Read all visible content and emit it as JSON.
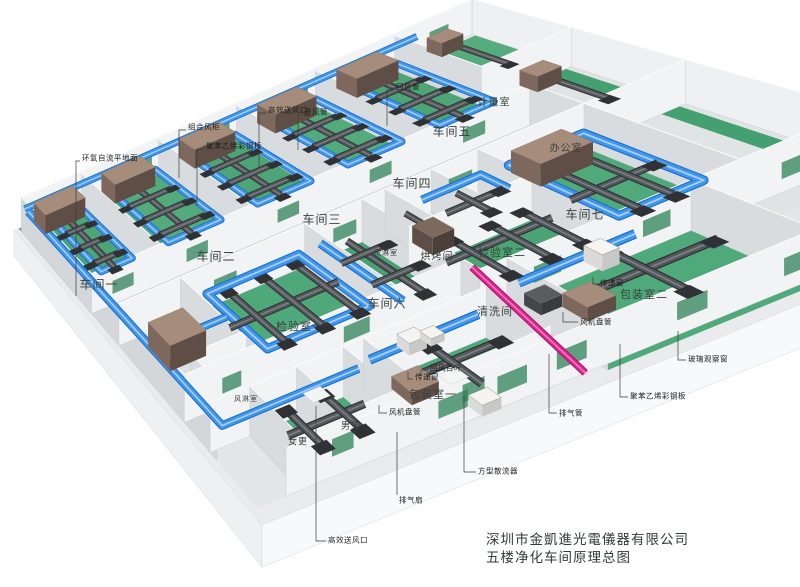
{
  "title_block": {
    "company": "深圳市金凱進光電儀器有限公司",
    "drawing_title": "五楼净化车间原理总图",
    "x": 486,
    "y": 531
  },
  "room_labels": [
    {
      "id": "workshop-1",
      "text": "车间一",
      "x": 99,
      "y": 284,
      "size": 12
    },
    {
      "id": "workshop-2",
      "text": "车间二",
      "x": 216,
      "y": 256,
      "size": 12
    },
    {
      "id": "workshop-3",
      "text": "车间三",
      "x": 322,
      "y": 219,
      "size": 12
    },
    {
      "id": "workshop-4",
      "text": "车间四",
      "x": 412,
      "y": 183,
      "size": 12
    },
    {
      "id": "workshop-5",
      "text": "车间五",
      "x": 452,
      "y": 131,
      "size": 12
    },
    {
      "id": "workshop-6",
      "text": "车间六",
      "x": 387,
      "y": 303,
      "size": 12
    },
    {
      "id": "workshop-7",
      "text": "车间七",
      "x": 585,
      "y": 214,
      "size": 12
    },
    {
      "id": "metering-room",
      "text": "计量室",
      "x": 494,
      "y": 101,
      "size": 10
    },
    {
      "id": "office",
      "text": "办公室",
      "x": 566,
      "y": 147,
      "size": 10
    },
    {
      "id": "inspection-room-1",
      "text": "检验室一",
      "x": 300,
      "y": 326,
      "size": 11
    },
    {
      "id": "inspection-room-2",
      "text": "检验室二",
      "x": 502,
      "y": 252,
      "size": 11
    },
    {
      "id": "baking-room",
      "text": "烘烤间",
      "x": 437,
      "y": 255,
      "size": 10
    },
    {
      "id": "cleaning-room",
      "text": "清洗间",
      "x": 495,
      "y": 311,
      "size": 11
    },
    {
      "id": "packing-room-1",
      "text": "包装室一",
      "x": 433,
      "y": 394,
      "size": 11
    },
    {
      "id": "packing-room-2",
      "text": "包装室二",
      "x": 644,
      "y": 294,
      "size": 11
    },
    {
      "id": "cargo-shower-room",
      "text": "货淋室",
      "x": 386,
      "y": 253,
      "size": 7
    },
    {
      "id": "air-shower-room",
      "text": "风淋室",
      "x": 246,
      "y": 399,
      "size": 7
    },
    {
      "id": "mens-changing",
      "text": "男更",
      "x": 351,
      "y": 425,
      "size": 9
    },
    {
      "id": "womens-changing",
      "text": "女更",
      "x": 298,
      "y": 441,
      "size": 9
    }
  ],
  "callout_labels": [
    {
      "id": "epoxy-floor",
      "text": "环氧自流平地面",
      "x": 82,
      "y": 158,
      "leader": [
        [
          80,
          161
        ],
        [
          76,
          161
        ],
        [
          76,
          296
        ]
      ]
    },
    {
      "id": "combined-ahu",
      "text": "组合风柜",
      "x": 188,
      "y": 127,
      "leader": [
        [
          186,
          130
        ],
        [
          179,
          130
        ],
        [
          179,
          178
        ]
      ]
    },
    {
      "id": "steel-panel-top",
      "text": "聚苯乙烯彩钢板",
      "x": 206,
      "y": 146,
      "leader": [
        [
          204,
          149
        ],
        [
          197,
          149
        ],
        [
          197,
          206
        ]
      ]
    },
    {
      "id": "hepa-outlet-top",
      "text": "高效送风口",
      "x": 268,
      "y": 110,
      "leader": [
        [
          266,
          113
        ],
        [
          259,
          113
        ],
        [
          259,
          168
        ]
      ]
    },
    {
      "id": "supply-duct",
      "text": "送风管",
      "x": 304,
      "y": 112,
      "leader": [
        [
          302,
          115
        ],
        [
          298,
          115
        ],
        [
          298,
          150
        ]
      ]
    },
    {
      "id": "return-duct",
      "text": "回风管",
      "x": 396,
      "y": 87,
      "leader": [
        [
          394,
          90
        ],
        [
          387,
          90
        ],
        [
          387,
          126
        ]
      ]
    },
    {
      "id": "return-louver",
      "text": "回风百叶",
      "x": 430,
      "y": 368,
      "leader": [
        [
          428,
          370
        ],
        [
          421,
          370
        ],
        [
          421,
          376
        ]
      ]
    },
    {
      "id": "transfer-window-1",
      "text": "传递窗",
      "x": 415,
      "y": 377,
      "leader": [
        [
          413,
          379
        ],
        [
          408,
          379
        ],
        [
          408,
          372
        ]
      ]
    },
    {
      "id": "fan-coil-1",
      "text": "风机盘管",
      "x": 389,
      "y": 412,
      "leader": [
        [
          387,
          413
        ],
        [
          379,
          413
        ],
        [
          379,
          405
        ]
      ]
    },
    {
      "id": "exhaust-fan",
      "text": "排气扇",
      "x": 399,
      "y": 500,
      "leader": [
        [
          397,
          495
        ],
        [
          397,
          432
        ]
      ]
    },
    {
      "id": "square-diffuser",
      "text": "方型散流器",
      "x": 478,
      "y": 471,
      "leader": [
        [
          476,
          472
        ],
        [
          464,
          472
        ],
        [
          464,
          396
        ]
      ]
    },
    {
      "id": "exhaust-pipe",
      "text": "排气管",
      "x": 559,
      "y": 413,
      "leader": [
        [
          557,
          413
        ],
        [
          549,
          413
        ],
        [
          549,
          354
        ]
      ]
    },
    {
      "id": "steel-panel-right",
      "text": "聚苯乙烯彩钢板",
      "x": 630,
      "y": 396,
      "leader": [
        [
          628,
          397
        ],
        [
          620,
          397
        ],
        [
          620,
          344
        ]
      ]
    },
    {
      "id": "glass-window",
      "text": "玻璃观察窗",
      "x": 688,
      "y": 359,
      "leader": [
        [
          686,
          360
        ],
        [
          678,
          360
        ],
        [
          678,
          331
        ]
      ]
    },
    {
      "id": "hepa-outlet-bottom",
      "text": "高效送风口",
      "x": 328,
      "y": 540,
      "leader": [
        [
          326,
          541
        ],
        [
          316,
          541
        ],
        [
          316,
          406
        ]
      ]
    },
    {
      "id": "transfer-window-2",
      "text": "传递窗",
      "x": 600,
      "y": 283,
      "leader": [
        [
          598,
          284
        ],
        [
          593,
          284
        ],
        [
          593,
          277
        ]
      ]
    },
    {
      "id": "fan-coil-2",
      "text": "风机盘管",
      "x": 580,
      "y": 322,
      "leader": [
        [
          578,
          322
        ],
        [
          563,
          322
        ],
        [
          563,
          312
        ]
      ]
    }
  ],
  "colors": {
    "floor_green": "#4ca477",
    "floor_green2": "#53ab7d",
    "floor_green3": "#4fa87a",
    "corridor_gray": "#dce0e1",
    "slab": "#e9ebec",
    "slab_face_left": "#eef1f2",
    "slab_face_front": "#f7f9fa",
    "wall_lit": "#f1f3f4",
    "wall_shade": "#d9dcdf",
    "wall_left": "#d3d7d9",
    "wall_right": "#eef0f2",
    "supply_duct_blue": "#3f96ec",
    "supply_duct_dark": "#1a6ec6",
    "supply_duct_hi": "#a8cef6",
    "exhaust_duct_gray": "#54575b",
    "exhaust_duct_dark": "#2f3134",
    "exhaust_duct_hi": "#7e8287",
    "ahu_brown_top": "#a58c7b",
    "ahu_brown_side": "#7e675c",
    "ahu_brown_front": "#5f4e46",
    "oven_top": "#7c6a5e",
    "oven_side": "#5d4f47",
    "oven_front": "#4a3f39",
    "white_box_top": "#f4f5f3",
    "white_box_side": "#dadbd8",
    "white_box_front": "#c8c9c6",
    "dark_box_top": "#5a5d60",
    "dark_box_side": "#44474a",
    "dark_box_front": "#393c3f",
    "exhaust_pipe_magenta": "#e12a90",
    "exhaust_pipe_hi": "#ff8ac4",
    "window_green": "#2f8159",
    "walkway_green": "#3f9d6e",
    "leader": "#3c3c3c"
  }
}
